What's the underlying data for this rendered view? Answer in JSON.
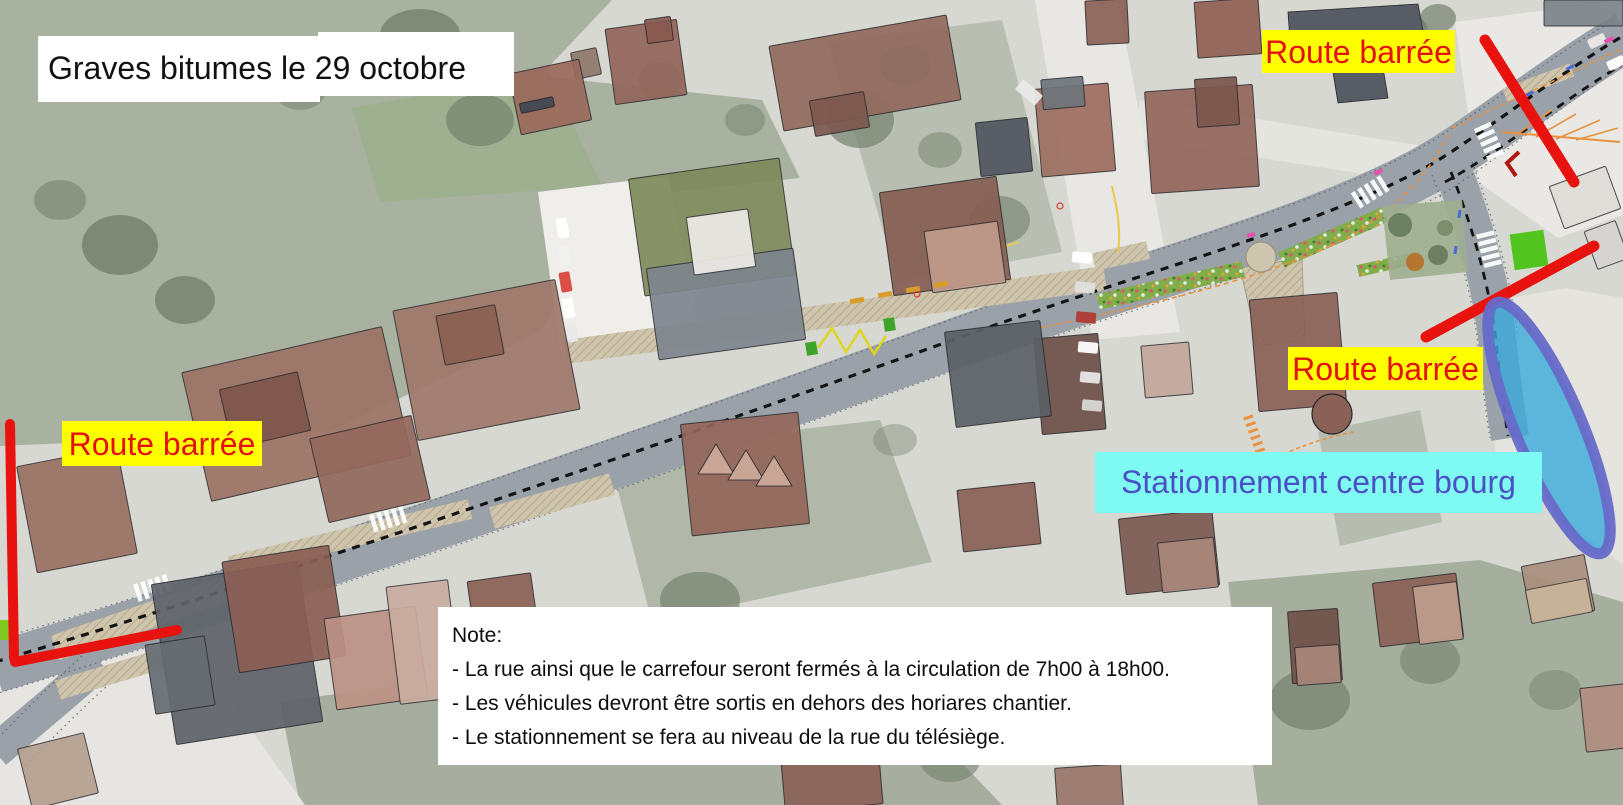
{
  "title": "Graves bitumes le 29 octobre",
  "labels": {
    "road_closed": "Route barrée",
    "parking": "Stationnement centre bourg"
  },
  "note": {
    "heading": "Note:",
    "items": [
      "- La rue ainsi que le carrefour seront fermés à la circulation de 7h00 à 18h00.",
      "- Les véhicules devront être sortis en dehors des horiares chantier.",
      "- Le stationnement se fera au niveau de la rue du télésiège."
    ]
  },
  "colors": {
    "label_highlight": "#ffff00",
    "label_red": "#e41111",
    "parking_box": "#7efaf2",
    "parking_text": "#4b50c4",
    "closure_line": "#e8120f",
    "parking_ellipse_fill": "#39a9da",
    "parking_ellipse_stroke": "#666ac8"
  },
  "map": {
    "base": "#d7d8d2",
    "tree_color": "#75816e",
    "fields": [
      {
        "p": "0,0 612,0 540,76 762,100 800,178 618,198 540,332 328,432 0,446",
        "f": "#a9b1a0"
      },
      {
        "p": "352,108 548,72 602,186 380,202",
        "f": "#9db08e",
        "o": 0.9
      },
      {
        "p": "280,702 700,642 902,700 1002,805 300,805",
        "f": "#a4ac9c",
        "o": 0.95
      },
      {
        "p": "608,452 880,420 932,562 652,622",
        "f": "#a8b0a0",
        "o": 0.8
      },
      {
        "p": "1228,582 1480,560 1623,602 1623,805 1258,805",
        "f": "#a6ae9e"
      },
      {
        "p": "828,42 1002,20 1062,252 898,282",
        "f": "#a8b0a0",
        "o": 0.65
      },
      {
        "p": "1318,432 1420,410 1442,522 1340,546",
        "f": "#a8b0a0",
        "o": 0.7
      }
    ],
    "pale": [
      {
        "p": "1035,0 1118,0 1180,332 1092,340",
        "f": "#e8e7e3"
      },
      {
        "p": "1140,100 1460,152 1452,188 1134,138",
        "f": "#e8e7e3",
        "o": 0.85
      },
      {
        "p": "1455,22 1623,0 1623,215 1558,238 1478,182",
        "f": "#eae8e4"
      },
      {
        "p": "1475,305 1565,288 1623,298 1623,565 1498,468",
        "f": "#e6e4df"
      },
      {
        "p": "538,192 668,176 702,342 560,348",
        "f": "#efeeeb"
      },
      {
        "p": "0,688 185,638 305,805 0,805",
        "f": "#e6e5e1"
      }
    ],
    "trees": [
      [
        120,
        245,
        38,
        30,
        0.85
      ],
      [
        185,
        300,
        30,
        24,
        0.8
      ],
      [
        60,
        200,
        26,
        20,
        0.6
      ],
      [
        420,
        35,
        40,
        26,
        0.8
      ],
      [
        480,
        120,
        34,
        26,
        0.7
      ],
      [
        300,
        90,
        26,
        20,
        0.5
      ],
      [
        660,
        80,
        22,
        18,
        0.6
      ],
      [
        745,
        120,
        20,
        16,
        0.5
      ],
      [
        860,
        120,
        34,
        28,
        0.7
      ],
      [
        905,
        65,
        26,
        20,
        0.6
      ],
      [
        1000,
        220,
        30,
        24,
        0.6
      ],
      [
        940,
        150,
        22,
        18,
        0.5
      ],
      [
        1398,
        32,
        30,
        22,
        0.9
      ],
      [
        1352,
        28,
        22,
        16,
        0.8
      ],
      [
        1438,
        18,
        18,
        14,
        0.7
      ],
      [
        700,
        600,
        40,
        28,
        0.7
      ],
      [
        590,
        680,
        34,
        24,
        0.6
      ],
      [
        850,
        705,
        42,
        28,
        0.7
      ],
      [
        950,
        760,
        30,
        22,
        0.6
      ],
      [
        760,
        680,
        26,
        20,
        0.5
      ],
      [
        1310,
        700,
        40,
        30,
        0.7
      ],
      [
        1430,
        660,
        30,
        24,
        0.6
      ],
      [
        1555,
        690,
        26,
        20,
        0.5
      ],
      [
        1350,
        490,
        26,
        20,
        0.6
      ],
      [
        835,
        380,
        24,
        18,
        0.5
      ],
      [
        895,
        440,
        22,
        16,
        0.4
      ]
    ],
    "roads": {
      "color": "#9aa1a8",
      "main": {
        "d": "M -5,668 C 250,590 600,470 950,345 C 1150,273 1320,230 1430,168 C 1480,140 1560,75 1628,36",
        "w": 50
      },
      "branch": {
        "d": "M 1452,168 C 1478,235 1492,290 1498,345 C 1502,385 1506,412 1510,438",
        "w": 38
      },
      "left": {
        "d": "M 100,662 C 60,698 25,726 -5,752",
        "w": 34
      },
      "kerbs": [
        "M -5,640 C 250,565 600,445 950,320 C 1150,248 1320,206 1425,145 C 1478,115 1555,52 1628,12",
        "M -5,694 C 250,618 600,498 950,372 C 1150,300 1330,258 1442,194 C 1490,166 1568,100 1628,62",
        "M 1432,175 C 1458,240 1472,295 1478,345 C 1482,385 1486,412 1490,438",
        "M 1472,162 C 1498,230 1512,288 1518,338",
        "M 82,656 C 45,690 15,720 -5,742",
        "M 118,676 C 80,710 48,742 22,770"
      ],
      "centerlines": [
        {
          "d": "M -5,662 C 250,586 600,466 950,341 C 1150,269 1320,226 1430,165 C 1480,136 1560,72 1628,33",
          "w": 3.2
        },
        {
          "d": "M 1445,182 C 1500,152 1560,102 1623,64",
          "w": 2.8
        },
        {
          "d": "M 1451,172 C 1476,236 1490,292 1496,340 C 1500,380 1504,410 1508,436",
          "w": 2.8
        }
      ]
    },
    "strips": [
      {
        "d": "M 55,648 L 235,586",
        "w": 26
      },
      {
        "d": "M 58,690 L 185,652",
        "w": 20
      },
      {
        "d": "M 230,566 L 470,509",
        "w": 20
      },
      {
        "d": "M 565,352 L 1105,278",
        "w": 24
      },
      {
        "d": "M 492,518 L 612,484",
        "w": 22
      },
      {
        "d": "M 1505,95 L 1572,70",
        "w": 14
      },
      {
        "d": "M 1094,262 L 1148,250",
        "w": 18
      }
    ],
    "plaza": {
      "p": "1240,268 1302,258 1305,340 1258,346",
      "f": "#c9bfa8"
    },
    "green_strips": [
      {
        "d": "M 1098,302 L 1243,269",
        "w": 16
      },
      {
        "d": "M 1281,260 L 1386,214",
        "w": 16
      },
      {
        "d": "M 1358,271 L 1420,257",
        "w": 12
      }
    ],
    "crosswalks": [
      [
        152,
        588,
        -18
      ],
      [
        388,
        519,
        -17
      ],
      [
        1370,
        192,
        -32
      ],
      [
        1489,
        141,
        66
      ],
      [
        1489,
        249,
        76
      ]
    ],
    "buildings": [
      [
        775,
        30,
        180,
        86,
        -10,
        "#90695d"
      ],
      [
        812,
        96,
        55,
        36,
        -10,
        "#7c584e"
      ],
      [
        573,
        50,
        26,
        27,
        -12,
        "#8d786a"
      ],
      [
        514,
        66,
        72,
        62,
        -12,
        "#99695b"
      ],
      [
        520,
        100,
        34,
        10,
        -12,
        "#3f4652"
      ],
      [
        610,
        24,
        72,
        76,
        -8,
        "#92655a"
      ],
      [
        646,
        18,
        26,
        24,
        -8,
        "#87584e"
      ],
      [
        636,
        168,
        152,
        118,
        -8,
        "#7e8a5b"
      ],
      [
        652,
        258,
        148,
        92,
        -8,
        "#7e848c"
      ],
      [
        690,
        213,
        62,
        58,
        -8,
        "#edebe7"
      ],
      [
        886,
        184,
        118,
        104,
        -8,
        "#855d53"
      ],
      [
        928,
        226,
        74,
        62,
        -8,
        "#c09a8b"
      ],
      [
        978,
        120,
        52,
        54,
        -6,
        "#50565f"
      ],
      [
        1038,
        86,
        74,
        88,
        -5,
        "#9b6e60"
      ],
      [
        1042,
        78,
        42,
        30,
        -5,
        "#6e747c"
      ],
      [
        1148,
        88,
        108,
        102,
        -4,
        "#93665a"
      ],
      [
        1196,
        78,
        42,
        48,
        -4,
        "#7c564c"
      ],
      [
        1254,
        296,
        88,
        112,
        -5,
        "#8a6156"
      ],
      [
        1038,
        336,
        64,
        96,
        -5,
        "#6d5049"
      ],
      [
        1143,
        344,
        48,
        52,
        -5,
        "#c2a79a"
      ],
      [
        194,
        348,
        205,
        132,
        -13,
        "#9c7265"
      ],
      [
        225,
        380,
        80,
        60,
        -13,
        "#7e564c"
      ],
      [
        318,
        426,
        104,
        86,
        -13,
        "#93685c"
      ],
      [
        404,
        294,
        165,
        132,
        -11,
        "#a0776a"
      ],
      [
        440,
        310,
        60,
        50,
        -11,
        "#8a5f53"
      ],
      [
        26,
        456,
        102,
        108,
        -11,
        "#9a7063"
      ],
      [
        163,
        572,
        148,
        162,
        -9,
        "#5e6269"
      ],
      [
        150,
        640,
        60,
        70,
        -9,
        "#666b72"
      ],
      [
        230,
        553,
        108,
        112,
        -9,
        "#8a5e54"
      ],
      [
        330,
        612,
        92,
        92,
        -8,
        "#bb9184"
      ],
      [
        393,
        583,
        62,
        118,
        -7,
        "#c9aca0"
      ],
      [
        470,
        577,
        64,
        46,
        -8,
        "#8a5f55"
      ],
      [
        24,
        740,
        68,
        62,
        -14,
        "#b5a08e"
      ],
      [
        686,
        418,
        118,
        112,
        -6,
        "#93665a"
      ],
      [
        950,
        326,
        96,
        96,
        -7,
        "#5b6067"
      ],
      [
        960,
        486,
        78,
        62,
        -6,
        "#8a6156"
      ],
      [
        1122,
        514,
        94,
        76,
        -6,
        "#7c5a52"
      ],
      [
        1160,
        540,
        56,
        50,
        -6,
        "#a98779"
      ],
      [
        1290,
        610,
        50,
        72,
        -4,
        "#6e5049"
      ],
      [
        1296,
        646,
        44,
        38,
        -4,
        "#a98779"
      ],
      [
        1376,
        578,
        84,
        64,
        -7,
        "#8a6156"
      ],
      [
        1416,
        584,
        44,
        58,
        -7,
        "#bf9d8d"
      ],
      [
        1526,
        560,
        64,
        57,
        -11,
        "#a88f7d"
      ],
      [
        1528,
        584,
        62,
        34,
        -11,
        "#c9b49b"
      ],
      [
        1583,
        686,
        44,
        64,
        -6,
        "#b08d80"
      ],
      [
        783,
        756,
        98,
        52,
        -5,
        "#8a6156"
      ],
      [
        1056,
        766,
        66,
        42,
        -4,
        "#99756a"
      ],
      [
        1086,
        0,
        42,
        44,
        -3,
        "#8a6156"
      ],
      [
        1196,
        0,
        64,
        56,
        -4,
        "#8f5f52"
      ],
      [
        1544,
        0,
        79,
        26,
        0,
        "#7d828a"
      ],
      [
        1555,
        175,
        60,
        45,
        -20,
        "#dddbd6"
      ],
      [
        1590,
        225,
        33,
        40,
        -20,
        "#d6d4cf"
      ],
      [
        1252,
        248,
        19,
        18,
        -8,
        "#eceae6"
      ]
    ],
    "polys": [
      {
        "p": "1382,206 1462,200 1468,272 1390,280",
        "f": "#9fae8e",
        "o": 0.9,
        "ns": true
      },
      {
        "p": "1288,12 1418,4 1428,58 1382,62 1388,98 1338,103 1332,66 1292,70",
        "f": "#575c65"
      },
      {
        "p": "698,474 716,444 734,474",
        "f": "#c8a595"
      },
      {
        "p": "728,480 746,450 764,480",
        "f": "#c8a595"
      },
      {
        "p": "756,486 774,456 792,486",
        "f": "#c8a595"
      }
    ],
    "circles": [
      {
        "cx": 1332,
        "cy": 414,
        "r": 20,
        "f": "#8a6156",
        "st": "#26262a"
      },
      {
        "cx": 1261,
        "cy": 257,
        "r": 15,
        "f": "#cfc6b0",
        "st": "#9a917c"
      },
      {
        "cx": 1400,
        "cy": 225,
        "r": 12,
        "f": "#6d7f63"
      },
      {
        "cx": 1438,
        "cy": 255,
        "r": 10,
        "f": "#6d7f63"
      },
      {
        "cx": 1445,
        "cy": 228,
        "r": 8,
        "f": "#7c8f6d"
      },
      {
        "cx": 1415,
        "cy": 262,
        "r": 9,
        "f": "#b4752f"
      },
      {
        "cx": 1060,
        "cy": 206,
        "r": 3,
        "f": "none",
        "st": "#d83a2e"
      },
      {
        "cx": 917,
        "cy": 294,
        "r": 3,
        "f": "none",
        "st": "#d83a2e"
      }
    ],
    "cars": [
      [
        557,
        218,
        11,
        20,
        -10,
        "#ffffff"
      ],
      [
        559,
        245,
        11,
        20,
        -10,
        "#f0f0ee"
      ],
      [
        560,
        272,
        11,
        20,
        -10,
        "#d8453c"
      ],
      [
        563,
        298,
        11,
        20,
        -10,
        "#ffffff"
      ],
      [
        566,
        322,
        11,
        20,
        -10,
        "#e8e8e8"
      ],
      [
        1072,
        252,
        20,
        11,
        5,
        "#ffffff"
      ],
      [
        1075,
        282,
        20,
        11,
        5,
        "#e0e0de"
      ],
      [
        1076,
        312,
        20,
        11,
        5,
        "#b03a34"
      ],
      [
        1078,
        342,
        20,
        11,
        5,
        "#ffffff"
      ],
      [
        1080,
        372,
        20,
        11,
        5,
        "#e8e8e6"
      ],
      [
        1082,
        400,
        20,
        11,
        5,
        "#d8d8d4"
      ],
      [
        1016,
        86,
        26,
        13,
        40,
        "#e9e9e7"
      ],
      [
        1588,
        36,
        18,
        10,
        -25,
        "#eceae8"
      ],
      [
        1607,
        58,
        18,
        10,
        -25,
        "#ffffff"
      ]
    ],
    "marks": [
      [
        850,
        298,
        14,
        5,
        -10,
        "#d89c28"
      ],
      [
        878,
        292,
        14,
        5,
        -10,
        "#d89c28"
      ],
      [
        906,
        287,
        14,
        5,
        -10,
        "#d89c28"
      ],
      [
        934,
        282,
        14,
        5,
        -10,
        "#d89c28"
      ],
      [
        806,
        342,
        11,
        13,
        -10,
        "#3fa32a"
      ],
      [
        884,
        318,
        11,
        13,
        -8,
        "#3fa32a"
      ],
      [
        1512,
        232,
        34,
        36,
        -8,
        "#52c41f"
      ],
      [
        0,
        620,
        9,
        20,
        0,
        "#7ec820"
      ],
      [
        1374,
        170,
        9,
        4,
        -25,
        "#e84fb0"
      ],
      [
        1604,
        38,
        10,
        4,
        -25,
        "#e84fb0"
      ],
      [
        1247,
        233,
        8,
        4,
        -15,
        "#e84fb0"
      ],
      [
        1526,
        92,
        8,
        3,
        -28,
        "#4668d8"
      ],
      [
        1566,
        66,
        8,
        3,
        -28,
        "#4668d8"
      ],
      [
        1458,
        210,
        3,
        8,
        8,
        "#4668d8"
      ],
      [
        1454,
        246,
        3,
        8,
        8,
        "#4668d8"
      ]
    ],
    "zigzag": {
      "pts": "818,348 832,328 846,352 860,330 874,354 886,336",
      "c": "#ded61e"
    },
    "detail_paths": [
      {
        "d": "M 1040,328 C 1140,306 1240,286 1330,246",
        "c": "#e8923f",
        "w": 1.6,
        "da": "5,4"
      },
      {
        "d": "M 1330,246 C 1390,220 1430,172 1452,130",
        "c": "#e8923f",
        "w": 1.6,
        "da": "5,4"
      },
      {
        "d": "M 1452,128 C 1500,106 1560,78 1623,48",
        "c": "#e8923f",
        "w": 1.6,
        "da": "5,4"
      },
      {
        "d": "M 1502,132 L 1620,142",
        "c": "#e8923f",
        "w": 2
      },
      {
        "d": "M 1516,135 L 1552,110",
        "c": "#e8923f",
        "w": 1.6
      },
      {
        "d": "M 1536,137 L 1576,114",
        "c": "#e8923f",
        "w": 1.6
      },
      {
        "d": "M 1556,139 L 1600,120",
        "c": "#e8923f",
        "w": 1.6
      },
      {
        "d": "M 1576,140 L 1618,128",
        "c": "#e8923f",
        "w": 1.6
      },
      {
        "d": "M 1248,416 L 1264,462",
        "c": "#e8923f",
        "w": 10,
        "da": "3,4"
      },
      {
        "d": "M 1252,470 C 1292,448 1322,438 1354,432",
        "c": "#e8923f",
        "w": 1.6,
        "da": "4,3"
      },
      {
        "d": "M 1112,186 C 1118,212 1121,232 1118,252",
        "c": "#ecc84c",
        "w": 2
      },
      {
        "d": "M 962,243 C 985,250 1005,248 1018,242",
        "c": "#ecc84c",
        "w": 2
      },
      {
        "d": "M 1519,152 L 1507,163 L 1516,176",
        "c": "#b01810",
        "w": 4
      }
    ],
    "red_lines": [
      [
        1485,
        40,
        1574,
        182,
        11
      ],
      [
        1426,
        337,
        1594,
        246,
        11
      ],
      [
        10,
        424,
        14,
        658,
        10
      ],
      [
        15,
        662,
        177,
        630,
        10
      ]
    ],
    "parking_ellipse": {
      "cx": 1549,
      "cy": 428,
      "rx": 33,
      "ry": 136,
      "rot": -23,
      "fill": "#39a9da",
      "stroke": "#666ac8",
      "sw": 11
    }
  }
}
